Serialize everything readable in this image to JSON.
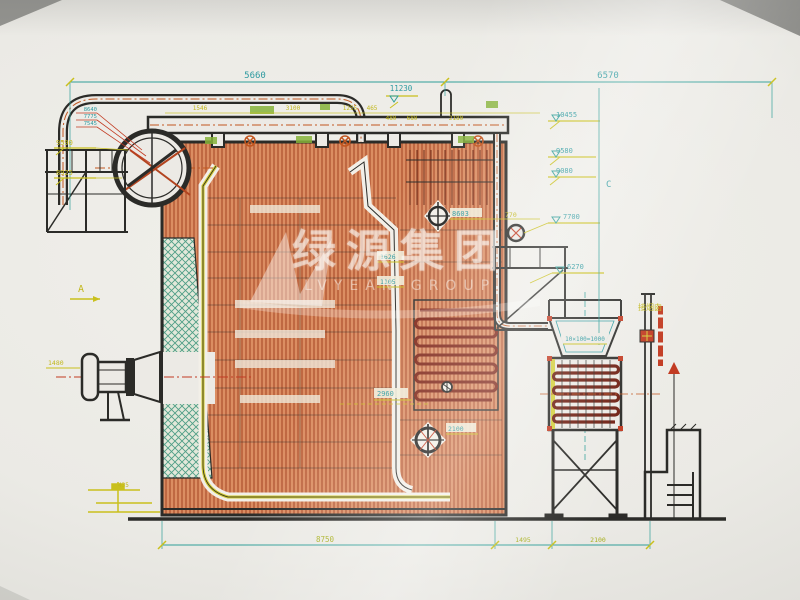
{
  "dims": {
    "top_left": "5660",
    "top_right": "6570",
    "level_top": "11230",
    "row": [
      "1546",
      "3100",
      "1255",
      "465",
      "480",
      "680",
      "2180"
    ],
    "bottom_main": "8750",
    "bottom_mid": "1495",
    "bottom_right": "2100"
  },
  "levels": {
    "left_small": [
      "8640",
      "7775",
      "7545"
    ],
    "left_yellow_upper": "9590",
    "left_yellow_lower": "8925",
    "right": [
      "10455",
      "9580",
      "9080",
      "7700",
      "6270"
    ]
  },
  "marks": {
    "section_a": "A",
    "section_c": "C",
    "burner_elev": "8603",
    "offset_770": "770",
    "inner_upper": "1626",
    "inner_lower": "1105",
    "depth_2960": "2960",
    "datum_2100": "2100",
    "tube_spacing": "10×100=1000",
    "chimney_note": "接烟囱",
    "left_edge": "1480",
    "bracket": "435"
  },
  "watermark": {
    "cn": "绿源集团",
    "en": "LVYEAN GROUP"
  },
  "colors": {
    "dim_teal": "#2f9e98",
    "label_yellow": "#c9c01c",
    "hatch_orange": "#c96a3e",
    "tube_red": "#7c2113",
    "line_black": "#2b2b28",
    "highlight_green": "#8fbf3a",
    "paper": "#eceae5"
  }
}
